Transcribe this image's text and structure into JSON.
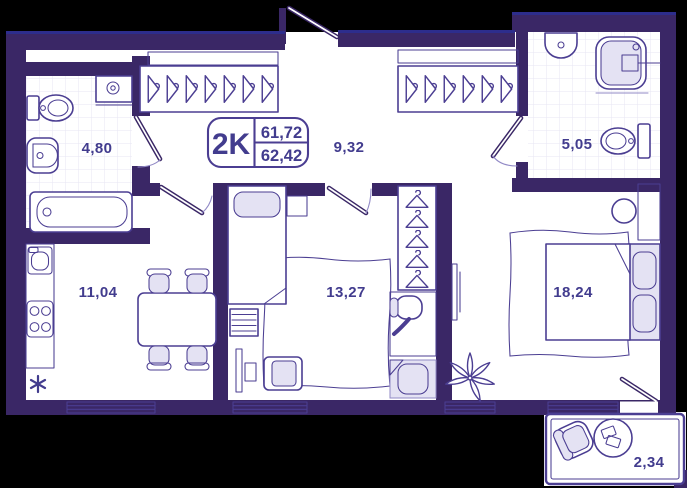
{
  "badge": {
    "type": "2K",
    "area_top": "61,72",
    "area_bottom": "62,42"
  },
  "rooms": {
    "bathroom_small": {
      "label": "4,80"
    },
    "hallway": {
      "label": "9,32"
    },
    "bathroom_large": {
      "label": "5,05"
    },
    "kitchen": {
      "label": "11,04"
    },
    "bedroom_small": {
      "label": "13,27"
    },
    "bedroom_large": {
      "label": "18,24"
    },
    "balcony": {
      "label": "2,34"
    }
  },
  "colors": {
    "background": "#000000",
    "wall": "#3A2766",
    "line": "#4B3E92",
    "line_light": "#9189C6",
    "text": "#423C8E",
    "fill_light": "#E4E2F3",
    "tile": "#E7E5F3",
    "accent": "#2D2D8C"
  }
}
